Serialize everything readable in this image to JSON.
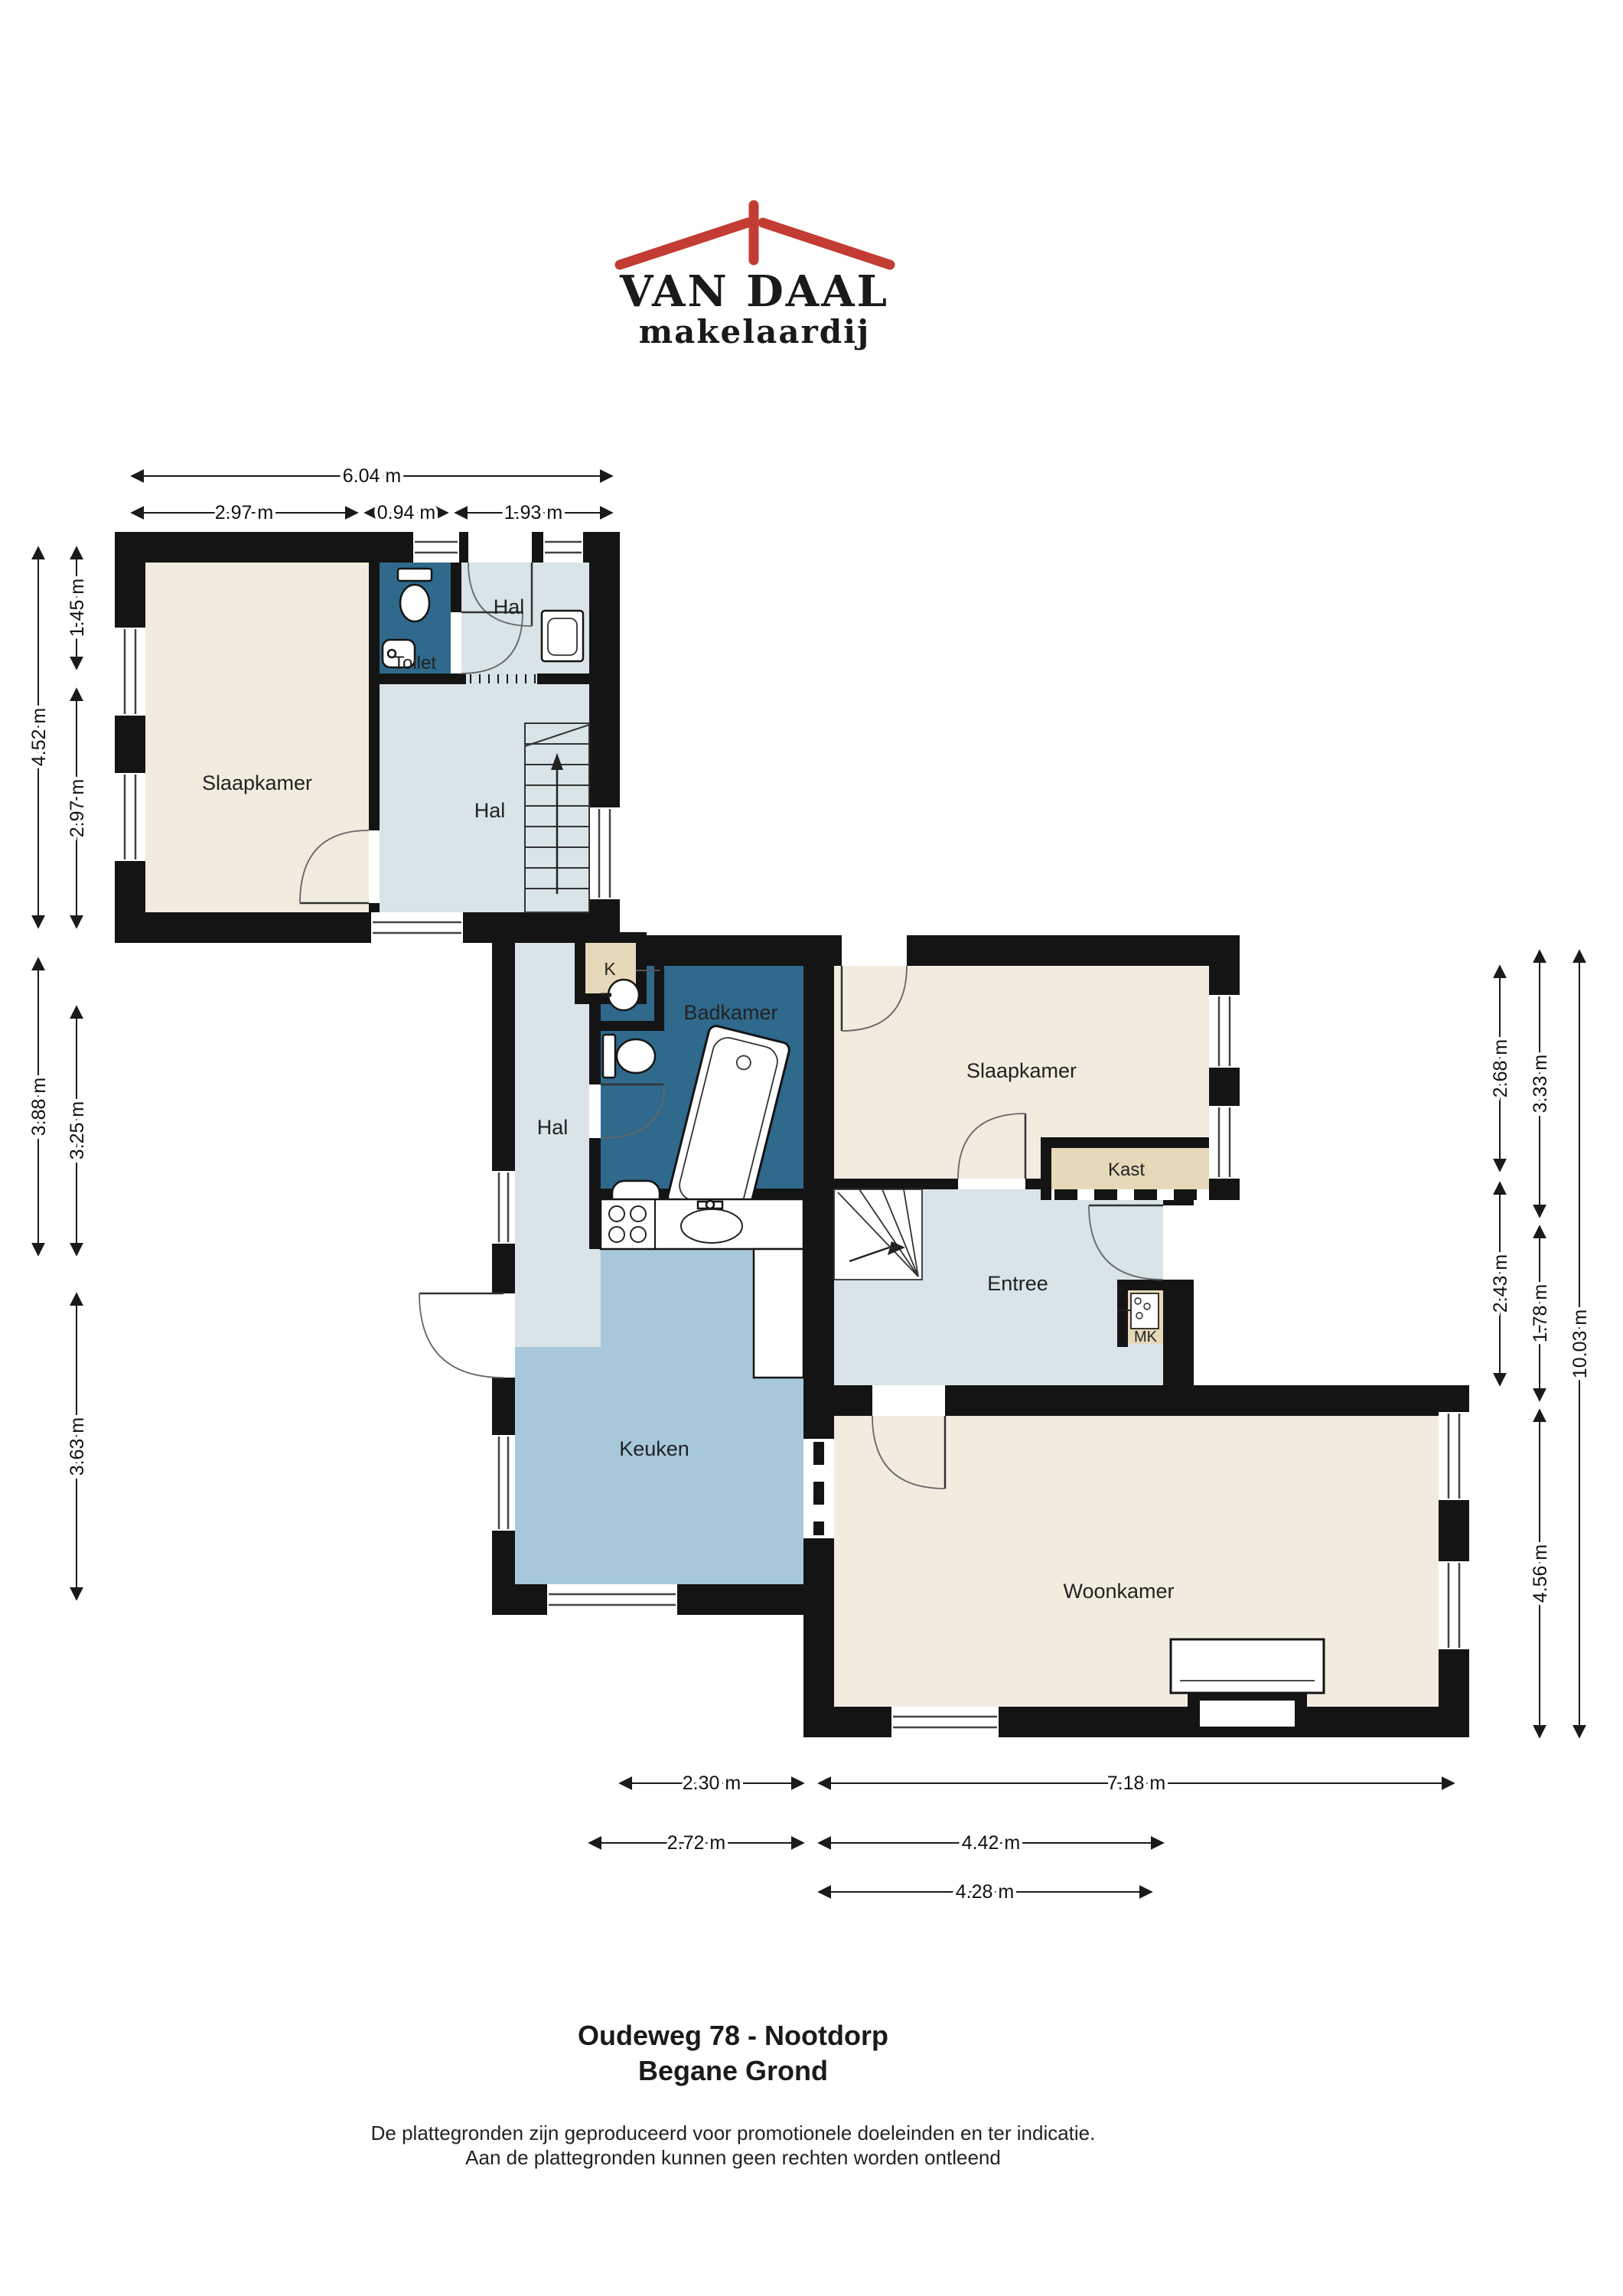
{
  "logo": {
    "name": "VAN DAAL",
    "tagline": "makelaardij",
    "navy": "#1d3a73",
    "red": "#c23c33"
  },
  "plan": {
    "rooms": {
      "slaapkamer1": "Slaapkamer",
      "toilet": "Toilet",
      "hal_top": "Hal",
      "hal_main": "Hal",
      "hal_strip": "Hal",
      "badkamer": "Badkamer",
      "k": "K",
      "slaapkamer2": "Slaapkamer",
      "kast": "Kast",
      "entree": "Entree",
      "mk": "MK",
      "keuken": "Keuken",
      "woonkamer": "Woonkamer"
    },
    "dims": {
      "top": [
        {
          "label": "6.04 m"
        },
        {
          "label": "2.97 m"
        },
        {
          "label": "0.94 m"
        },
        {
          "label": "1.93 m"
        }
      ],
      "left": [
        {
          "label": "4.52 m"
        },
        {
          "label": "1.45 m"
        },
        {
          "label": "2.97 m"
        },
        {
          "label": "3.88 m"
        },
        {
          "label": "3.25 m"
        },
        {
          "label": "3.63 m"
        }
      ],
      "right": [
        {
          "label": "2.68 m"
        },
        {
          "label": "2.43 m"
        },
        {
          "label": "3.33 m"
        },
        {
          "label": "1.78 m"
        },
        {
          "label": "4.56 m"
        },
        {
          "label": "10.03 m"
        }
      ],
      "bottom": [
        {
          "label": "2.30 m"
        },
        {
          "label": "7.18 m"
        },
        {
          "label": "2.72 m"
        },
        {
          "label": "4.42 m"
        },
        {
          "label": "4.28 m"
        }
      ]
    }
  },
  "footer": {
    "address": "Oudeweg 78 - Nootdorp",
    "floor": "Begane Grond",
    "disclaimer1": "De plattegronden zijn geproduceerd voor promotionele doeleinden en ter indicatie.",
    "disclaimer2": "Aan de plattegronden kunnen geen rechten worden ontleend"
  },
  "colors": {
    "wall": "#141414",
    "room_cream": "#f2ecdf",
    "room_lightblue": "#d8e4e7",
    "room_mediumblue": "#a7c8db",
    "room_darkblue": "#2f698c",
    "closet_beige": "#e6d9b9"
  }
}
